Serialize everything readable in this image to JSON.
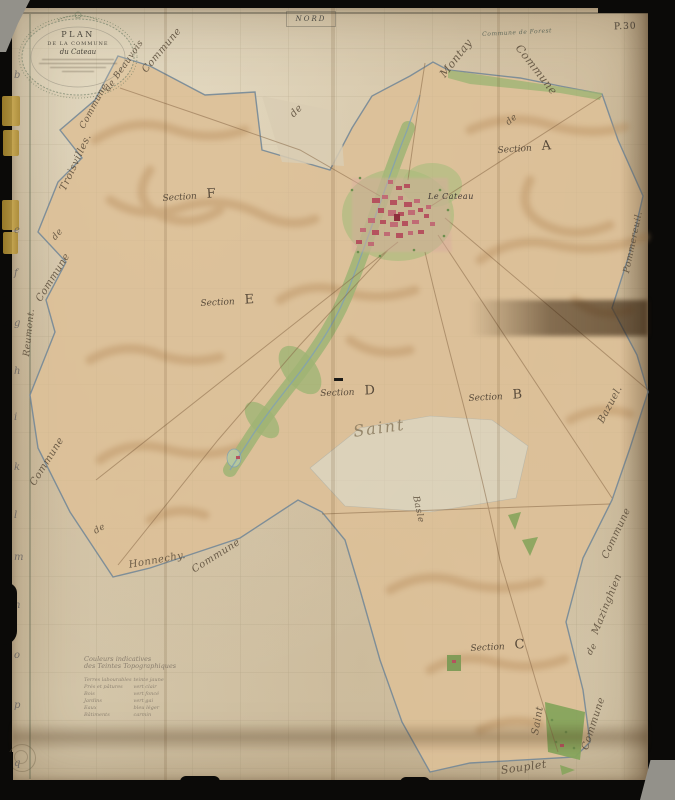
{
  "stamps": {
    "north": "NORD",
    "plate": "P.30"
  },
  "cartouche": {
    "line1": "PLAN",
    "line2": "DE LA COMMUNE",
    "line3": "du Cateau"
  },
  "sections": {
    "word": "Section",
    "a": "A",
    "b": "B",
    "c": "C",
    "d": "D",
    "e": "E",
    "f": "F"
  },
  "village": {
    "name": "Le Cateau"
  },
  "place_labels": {
    "saint": "Saint",
    "basle": "Basle"
  },
  "border_labels": {
    "top_commune": "Commune",
    "montay": "Montay",
    "forest": "Commune de Forest",
    "de_top": "de",
    "nw_commune": "Commune",
    "beauvois": "de Beauvois",
    "trois_commune": "Commune",
    "troisvilles": "Troisvilles.",
    "de_left": "de",
    "left_commune": "Commune",
    "reumont": "Reumont.",
    "sw_commune": "Commune",
    "de_sw": "de",
    "honnechy": "Honnechy.",
    "honnechy_commune": "Commune",
    "pommereuil": "Pommereuil.",
    "bazuel": "Bazuel.",
    "se_commune": "Commune",
    "de_se": "de",
    "mazinghien": "Mazinghien",
    "saint_v": "Saint",
    "souplet": "Souplet",
    "s_commune": "Commune",
    "de_gap": "de"
  },
  "margin_letters": [
    "b",
    "e",
    "f",
    "g",
    "h",
    "i",
    "k",
    "l",
    "m",
    "n",
    "o",
    "p",
    "q"
  ],
  "legend": {
    "title_line1": "Couleurs indicatives",
    "title_line2": "des Teintes Topographiques",
    "rows": [
      [
        "Terres labourables",
        "teinte jaune"
      ],
      [
        "Prés et pâtures",
        "vert clair"
      ],
      [
        "Bois",
        "vert foncé"
      ],
      [
        "Jardins",
        "vert gai"
      ],
      [
        "Eaux",
        "bleu léger"
      ],
      [
        "Bâtiments",
        "carmin"
      ]
    ]
  },
  "palette": {
    "paper": "#d9cdb3",
    "territory": "#dcc098",
    "meadow_green": "#a9bc7d",
    "building_red": "#b5525e",
    "boundary_blue": "#6f8596",
    "ink": "#584a38"
  }
}
